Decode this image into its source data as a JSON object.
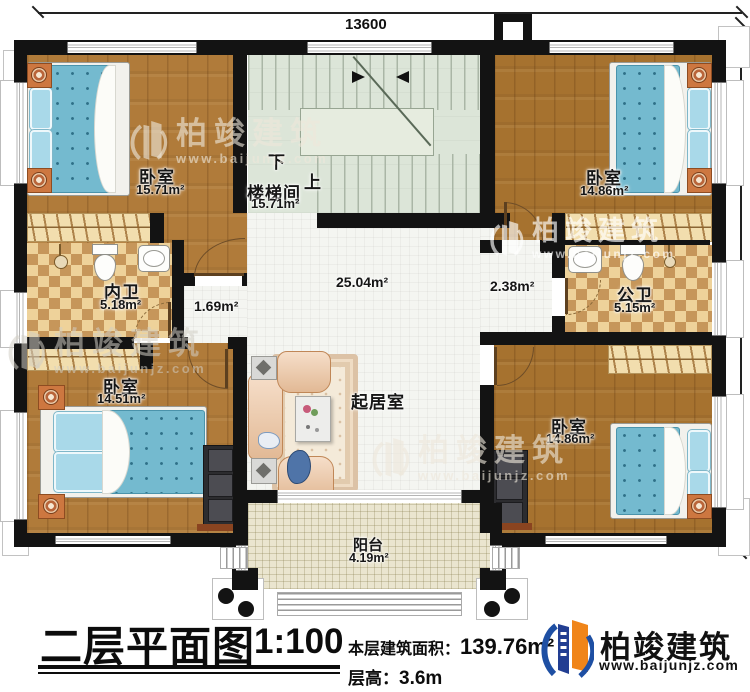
{
  "dimensions": {
    "width_mm": "13600",
    "height_mm": "10800"
  },
  "rooms": {
    "bedroom_tl": {
      "name": "卧室",
      "area": "15.71m²"
    },
    "stairwell": {
      "name": "楼梯间",
      "area": "15.71m²",
      "down": "下",
      "up": "上"
    },
    "bedroom_tr": {
      "name": "卧室",
      "area": "14.86m²"
    },
    "bath_inner": {
      "name": "内卫",
      "area": "5.18m²"
    },
    "bath_public": {
      "name": "公卫",
      "area": "5.15m²"
    },
    "bedroom_bl": {
      "name": "卧室",
      "area": "14.51m²"
    },
    "bedroom_br": {
      "name": "卧室",
      "area": "14.86m²"
    },
    "living": {
      "name": "起居室"
    },
    "balcony": {
      "name": "阳台",
      "area": "4.19m²"
    },
    "hall_area": "25.04m²",
    "nook_area": "1.69m²",
    "corridor_area": "2.38m²"
  },
  "title_block": {
    "title": "二层平面图",
    "scale": "1:100",
    "floor_area_label": "本层建筑面积：",
    "floor_area_value": "139.76m²",
    "floor_height_label": "层高：",
    "floor_height_value": "3.6m"
  },
  "brand": {
    "name": "柏竣建筑",
    "website": "www.baijunjz.com"
  },
  "watermark": {
    "name": "柏竣建筑",
    "website": "www.baijunjz.com"
  },
  "colors": {
    "wall": "#131313",
    "wood": "#b07b3a",
    "checker_dark": "#c6965a",
    "stair": "#dce5d8",
    "balcony": "#eae5cf",
    "bed": "#74bacf",
    "brand_blue": "#1e4fa3",
    "brand_orange": "#f08519"
  }
}
